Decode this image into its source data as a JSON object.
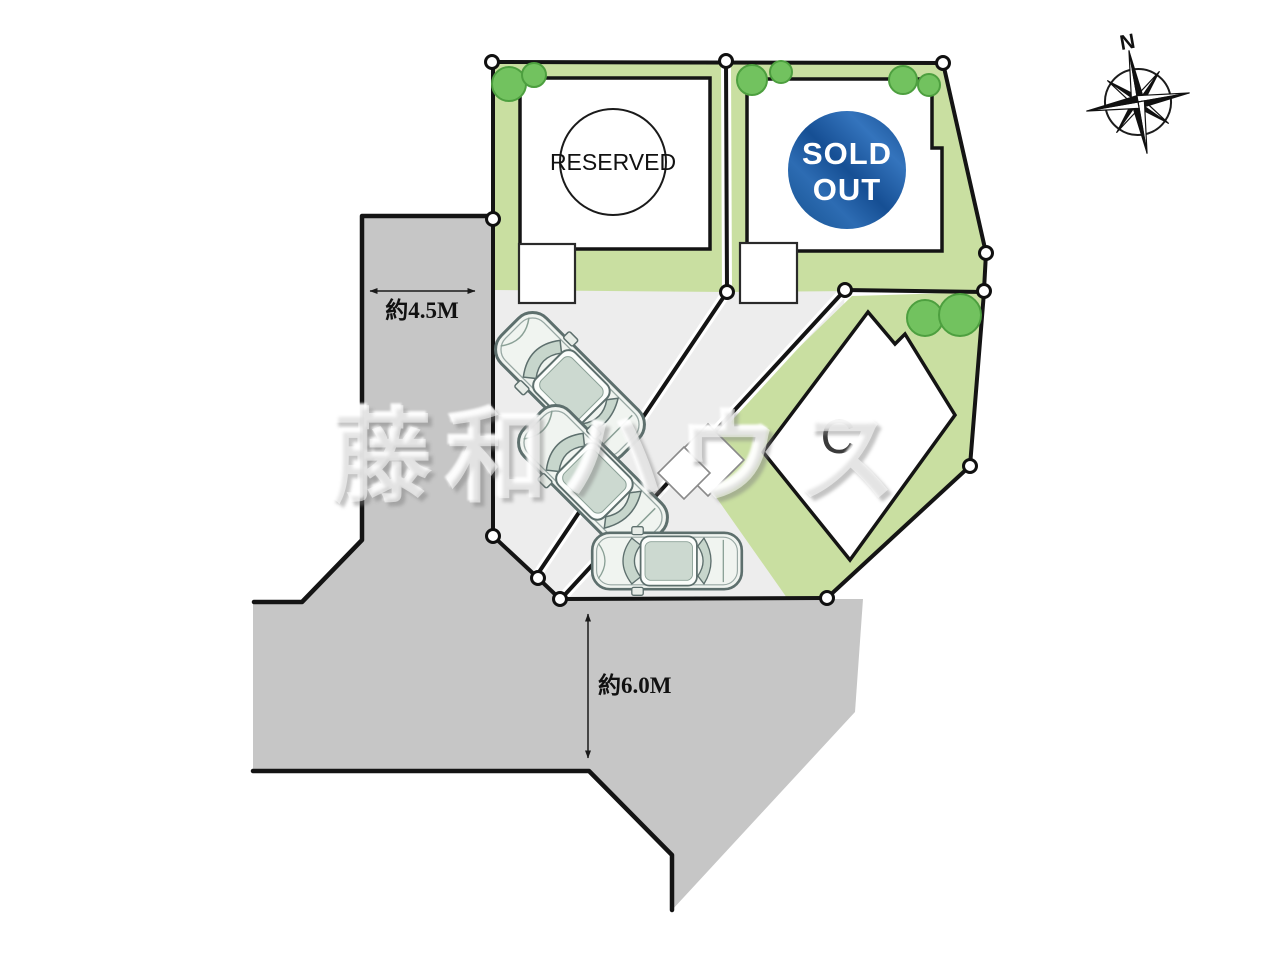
{
  "watermark": {
    "text": "藤和ハウス"
  },
  "compass": {
    "label": "N"
  },
  "plots": {
    "reserved": {
      "status": "RESERVED"
    },
    "sold_out": {
      "status_line1": "SOLD",
      "status_line2": "OUT"
    },
    "c": {
      "label": "C"
    }
  },
  "dimensions": {
    "road_west_width": "約4.5M",
    "road_south_width": "約6.0M"
  },
  "colors": {
    "road": "#c6c6c6",
    "parking": "#ededed",
    "lawn": "#c9dfa1",
    "tree": "#72c25f",
    "tree_edge": "#4d9f3f",
    "boundary": "#141414",
    "sold_badge": "#17549b",
    "badge_text": "#ffffff"
  }
}
